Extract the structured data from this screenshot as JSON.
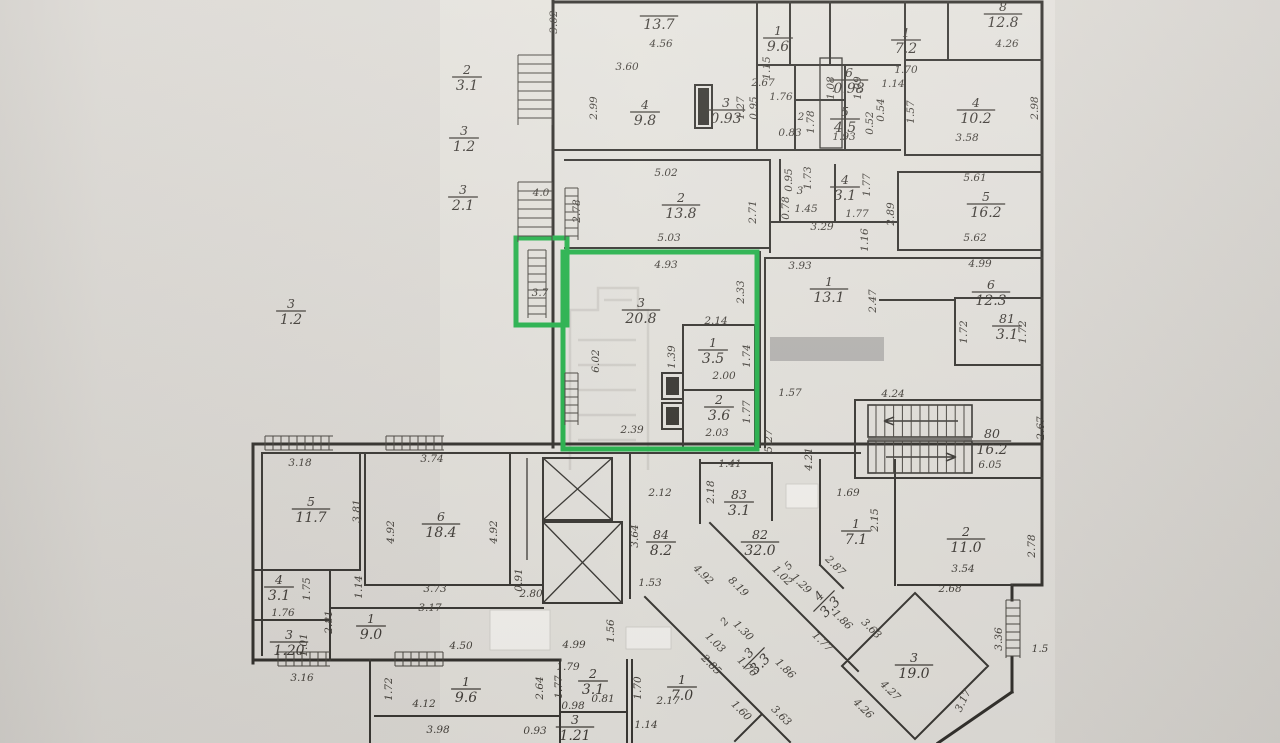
{
  "floorplan": {
    "type": "apartment-building-floor-plan-scan",
    "colors": {
      "paper": "#dcd9d4",
      "plan_background": "#e9e6e1",
      "ink": "#45413b",
      "highlight_green": "#27b44d",
      "redaction_gray": "#b7b5b2",
      "redaction_white": "#f5f3ef"
    },
    "highlighted_apartment": {
      "balcony_area": "3.7",
      "rooms": [
        {
          "num": "3",
          "area": "20.8"
        },
        {
          "num": "1",
          "area": "3.5"
        },
        {
          "num": "2",
          "area": "3.6"
        }
      ]
    },
    "rooms": [
      {
        "num": "",
        "area": "13.7",
        "x": 659,
        "y": 16
      },
      {
        "num": "4",
        "area": "9.8",
        "x": 645,
        "y": 112
      },
      {
        "num": "3",
        "area": "0.93",
        "x": 726,
        "y": 110
      },
      {
        "num": "1",
        "area": "9.6",
        "x": 778,
        "y": 38
      },
      {
        "num": "6",
        "area": "0.98",
        "x": 849,
        "y": 80
      },
      {
        "num": "5",
        "area": "4.5",
        "x": 845,
        "y": 119
      },
      {
        "num": "1",
        "area": "7.2",
        "x": 906,
        "y": 40
      },
      {
        "num": "8",
        "area": "12.8",
        "x": 1003,
        "y": 14
      },
      {
        "num": "4",
        "area": "10.2",
        "x": 976,
        "y": 110
      },
      {
        "num": "2",
        "area": "13.8",
        "x": 681,
        "y": 205
      },
      {
        "num": "4",
        "area": "3.1",
        "x": 845,
        "y": 187
      },
      {
        "num": "5",
        "area": "16.2",
        "x": 986,
        "y": 204
      },
      {
        "num": "1",
        "area": "13.1",
        "x": 829,
        "y": 289
      },
      {
        "num": "6",
        "area": "12.3",
        "x": 991,
        "y": 292
      },
      {
        "num": "3",
        "area": "20.8",
        "x": 641,
        "y": 310
      },
      {
        "num": "1",
        "area": "3.5",
        "x": 713,
        "y": 350
      },
      {
        "num": "2",
        "area": "3.6",
        "x": 719,
        "y": 407
      },
      {
        "num": "81",
        "area": "3.1",
        "x": 1007,
        "y": 326
      },
      {
        "num": "80",
        "area": "16.2",
        "x": 992,
        "y": 441
      },
      {
        "num": "5",
        "area": "11.7",
        "x": 311,
        "y": 509
      },
      {
        "num": "6",
        "area": "18.4",
        "x": 441,
        "y": 524
      },
      {
        "num": "4",
        "area": "3.1",
        "x": 279,
        "y": 587
      },
      {
        "num": "3",
        "area": "1.20",
        "x": 289,
        "y": 642
      },
      {
        "num": "1",
        "area": "9.0",
        "x": 371,
        "y": 626
      },
      {
        "num": "84",
        "area": "8.2",
        "x": 661,
        "y": 542
      },
      {
        "num": "83",
        "area": "3.1",
        "x": 739,
        "y": 502
      },
      {
        "num": "82",
        "area": "32.0",
        "x": 760,
        "y": 542
      },
      {
        "num": "1",
        "area": "7.1",
        "x": 856,
        "y": 531
      },
      {
        "num": "2",
        "area": "11.0",
        "x": 966,
        "y": 539
      },
      {
        "num": "3",
        "area": "19.0",
        "x": 914,
        "y": 665
      },
      {
        "num": "1",
        "area": "9.6",
        "x": 466,
        "y": 689
      },
      {
        "num": "2",
        "area": "3.1",
        "x": 593,
        "y": 681
      },
      {
        "num": "3",
        "area": "1.21",
        "x": 575,
        "y": 727
      },
      {
        "num": "1",
        "area": "7.0",
        "x": 682,
        "y": 687
      },
      {
        "num": "3",
        "area": "3.3",
        "x": 754,
        "y": 658,
        "r": -45
      },
      {
        "num": "4",
        "area": "3.3",
        "x": 824,
        "y": 601,
        "r": -45
      },
      {
        "num": "2",
        "area": "3.1",
        "x": 467,
        "y": 77
      },
      {
        "num": "3",
        "area": "1.2",
        "x": 464,
        "y": 138
      },
      {
        "num": "3",
        "area": "2.1",
        "x": 463,
        "y": 197
      },
      {
        "num": "3",
        "area": "1.2",
        "x": 291,
        "y": 311
      }
    ],
    "dimensions": [
      {
        "t": "4.0",
        "x": 541,
        "y": 196,
        "s": 14
      },
      {
        "t": "3.7",
        "x": 540,
        "y": 296,
        "s": 14
      },
      {
        "t": "2",
        "x": 801,
        "y": 120,
        "s": 15
      },
      {
        "t": "3",
        "x": 800,
        "y": 194,
        "s": 13
      },
      {
        "t": "2",
        "x": 727,
        "y": 624,
        "r": -45,
        "s": 14
      },
      {
        "t": "5",
        "x": 791,
        "y": 568,
        "r": -45,
        "s": 13
      },
      {
        "t": "4.56",
        "x": 661,
        "y": 47
      },
      {
        "t": "3.60",
        "x": 627,
        "y": 70
      },
      {
        "t": "2.99",
        "x": 597,
        "y": 108,
        "r": -90
      },
      {
        "t": "3.02",
        "x": 557,
        "y": 22,
        "r": -90
      },
      {
        "t": "1.15",
        "x": 770,
        "y": 68,
        "r": -90
      },
      {
        "t": "2.67",
        "x": 763,
        "y": 86
      },
      {
        "t": "1.27",
        "x": 744,
        "y": 108,
        "r": -90
      },
      {
        "t": "0.95",
        "x": 757,
        "y": 108,
        "r": -90
      },
      {
        "t": "1.76",
        "x": 781,
        "y": 100
      },
      {
        "t": "1.78",
        "x": 814,
        "y": 122,
        "r": -90
      },
      {
        "t": "0.83",
        "x": 790,
        "y": 136
      },
      {
        "t": "1.08",
        "x": 834,
        "y": 88,
        "r": -90
      },
      {
        "t": "1.09",
        "x": 861,
        "y": 88,
        "r": -90
      },
      {
        "t": "1.70",
        "x": 906,
        "y": 73
      },
      {
        "t": "1.14",
        "x": 893,
        "y": 87
      },
      {
        "t": "0.54",
        "x": 884,
        "y": 110,
        "r": -90
      },
      {
        "t": "1.57",
        "x": 914,
        "y": 112,
        "r": -90
      },
      {
        "t": "0.52",
        "x": 873,
        "y": 123,
        "r": -90
      },
      {
        "t": "1.93",
        "x": 844,
        "y": 140
      },
      {
        "t": "4.26",
        "x": 1007,
        "y": 47
      },
      {
        "t": "2.98",
        "x": 1038,
        "y": 108,
        "r": -90
      },
      {
        "t": "3.58",
        "x": 967,
        "y": 141
      },
      {
        "t": "5.02",
        "x": 666,
        "y": 176
      },
      {
        "t": "5.03",
        "x": 669,
        "y": 241
      },
      {
        "t": "2.78",
        "x": 580,
        "y": 211,
        "r": -90
      },
      {
        "t": "2.71",
        "x": 756,
        "y": 212,
        "r": -90
      },
      {
        "t": "0.95",
        "x": 792,
        "y": 180,
        "r": -90
      },
      {
        "t": "1.73",
        "x": 811,
        "y": 178,
        "r": -90
      },
      {
        "t": "0.78",
        "x": 789,
        "y": 208,
        "r": -90
      },
      {
        "t": "1.45",
        "x": 806,
        "y": 212
      },
      {
        "t": "1.77",
        "x": 870,
        "y": 185,
        "r": -90
      },
      {
        "t": "1.77",
        "x": 857,
        "y": 217
      },
      {
        "t": "3.29",
        "x": 822,
        "y": 230
      },
      {
        "t": "1.16",
        "x": 868,
        "y": 240,
        "r": -90
      },
      {
        "t": "2.89",
        "x": 894,
        "y": 214,
        "r": -90
      },
      {
        "t": "5.61",
        "x": 975,
        "y": 181
      },
      {
        "t": "5.62",
        "x": 975,
        "y": 241
      },
      {
        "t": "3.93",
        "x": 800,
        "y": 269
      },
      {
        "t": "2.47",
        "x": 876,
        "y": 301,
        "r": -90
      },
      {
        "t": "4.99",
        "x": 980,
        "y": 267
      },
      {
        "t": "4.93",
        "x": 666,
        "y": 268
      },
      {
        "t": "2.33",
        "x": 744,
        "y": 292,
        "r": -90
      },
      {
        "t": "2.14",
        "x": 716,
        "y": 324
      },
      {
        "t": "1.39",
        "x": 675,
        "y": 357,
        "r": -90
      },
      {
        "t": "1.74",
        "x": 750,
        "y": 356,
        "r": -90
      },
      {
        "t": "2.00",
        "x": 724,
        "y": 379
      },
      {
        "t": "1.77",
        "x": 750,
        "y": 412,
        "r": -90
      },
      {
        "t": "2.03",
        "x": 717,
        "y": 436
      },
      {
        "t": "2.39",
        "x": 632,
        "y": 433
      },
      {
        "t": "6.02",
        "x": 599,
        "y": 361,
        "r": -90
      },
      {
        "t": "1.57",
        "x": 790,
        "y": 396
      },
      {
        "t": "4.24",
        "x": 893,
        "y": 397
      },
      {
        "t": "5.27",
        "x": 772,
        "y": 441,
        "r": -90
      },
      {
        "t": "4.21",
        "x": 812,
        "y": 459,
        "r": -90
      },
      {
        "t": "6.05",
        "x": 990,
        "y": 468
      },
      {
        "t": "2.67",
        "x": 1044,
        "y": 428,
        "r": -90
      },
      {
        "t": "1.72",
        "x": 967,
        "y": 332,
        "r": -90
      },
      {
        "t": "1.72",
        "x": 1026,
        "y": 332,
        "r": -90
      },
      {
        "t": "1.69",
        "x": 848,
        "y": 496
      },
      {
        "t": "2.15",
        "x": 878,
        "y": 520,
        "r": -90
      },
      {
        "t": "3.18",
        "x": 300,
        "y": 466
      },
      {
        "t": "3.74",
        "x": 432,
        "y": 462
      },
      {
        "t": "3.81",
        "x": 360,
        "y": 511,
        "r": -90
      },
      {
        "t": "4.92",
        "x": 394,
        "y": 532,
        "r": -90
      },
      {
        "t": "4.92",
        "x": 497,
        "y": 532,
        "r": -90
      },
      {
        "t": "1.14",
        "x": 362,
        "y": 587,
        "r": -90
      },
      {
        "t": "1.76",
        "x": 283,
        "y": 616
      },
      {
        "t": "1.75",
        "x": 310,
        "y": 589,
        "r": -90
      },
      {
        "t": "2.81",
        "x": 332,
        "y": 622,
        "r": -90
      },
      {
        "t": "1.01",
        "x": 307,
        "y": 645,
        "r": -90
      },
      {
        "t": "3.73",
        "x": 435,
        "y": 592
      },
      {
        "t": "3.17",
        "x": 430,
        "y": 611
      },
      {
        "t": "0.91",
        "x": 522,
        "y": 580,
        "r": -90
      },
      {
        "t": "2.80",
        "x": 531,
        "y": 597
      },
      {
        "t": "4.50",
        "x": 461,
        "y": 649
      },
      {
        "t": "3.16",
        "x": 302,
        "y": 681
      },
      {
        "t": "2.12",
        "x": 660,
        "y": 496
      },
      {
        "t": "3.64",
        "x": 638,
        "y": 536,
        "r": -90
      },
      {
        "t": "1.53",
        "x": 650,
        "y": 586
      },
      {
        "t": "1.41",
        "x": 730,
        "y": 467
      },
      {
        "t": "2.18",
        "x": 714,
        "y": 492,
        "r": -90
      },
      {
        "t": "4.92",
        "x": 701,
        "y": 577,
        "r": 45
      },
      {
        "t": "8.19",
        "x": 736,
        "y": 589,
        "r": 45
      },
      {
        "t": "1.56",
        "x": 614,
        "y": 631,
        "r": -90
      },
      {
        "t": "4.99",
        "x": 574,
        "y": 648
      },
      {
        "t": "1.72",
        "x": 392,
        "y": 689,
        "r": -90
      },
      {
        "t": "4.12",
        "x": 424,
        "y": 707
      },
      {
        "t": "3.98",
        "x": 438,
        "y": 733
      },
      {
        "t": "2.64",
        "x": 543,
        "y": 688,
        "r": -90
      },
      {
        "t": "1.79",
        "x": 568,
        "y": 670
      },
      {
        "t": "1.77",
        "x": 562,
        "y": 687,
        "r": -90
      },
      {
        "t": "0.81",
        "x": 603,
        "y": 702
      },
      {
        "t": "0.98",
        "x": 573,
        "y": 709
      },
      {
        "t": "0.93",
        "x": 535,
        "y": 734
      },
      {
        "t": "1.70",
        "x": 641,
        "y": 688,
        "r": -90
      },
      {
        "t": "2.17",
        "x": 668,
        "y": 704
      },
      {
        "t": "1.14",
        "x": 646,
        "y": 728
      },
      {
        "t": "2.85",
        "x": 709,
        "y": 667,
        "r": 45
      },
      {
        "t": "1.30",
        "x": 741,
        "y": 633,
        "r": 45
      },
      {
        "t": "1.03",
        "x": 713,
        "y": 645,
        "r": 45
      },
      {
        "t": "1.02",
        "x": 780,
        "y": 578,
        "r": 45
      },
      {
        "t": "1.29",
        "x": 799,
        "y": 586,
        "r": 45
      },
      {
        "t": "1.76",
        "x": 745,
        "y": 669,
        "r": 45
      },
      {
        "t": "1.86",
        "x": 783,
        "y": 671,
        "r": 45
      },
      {
        "t": "1.60",
        "x": 739,
        "y": 713,
        "r": 45
      },
      {
        "t": "3.63",
        "x": 779,
        "y": 718,
        "r": 45
      },
      {
        "t": "2.87",
        "x": 833,
        "y": 568,
        "r": 45
      },
      {
        "t": "1.86",
        "x": 840,
        "y": 622,
        "r": 45
      },
      {
        "t": "1.77",
        "x": 820,
        "y": 644,
        "r": 45
      },
      {
        "t": "3.54",
        "x": 963,
        "y": 572
      },
      {
        "t": "2.78",
        "x": 1035,
        "y": 546,
        "r": -90
      },
      {
        "t": "2.68",
        "x": 950,
        "y": 592
      },
      {
        "t": "3.63",
        "x": 869,
        "y": 631,
        "r": 45
      },
      {
        "t": "4.27",
        "x": 888,
        "y": 693,
        "r": 45
      },
      {
        "t": "4.26",
        "x": 861,
        "y": 711,
        "r": 45
      },
      {
        "t": "3.17",
        "x": 966,
        "y": 702,
        "r": -65
      },
      {
        "t": "3.36",
        "x": 1002,
        "y": 639,
        "r": -90
      },
      {
        "t": "1.5",
        "x": 1040,
        "y": 652
      }
    ]
  }
}
